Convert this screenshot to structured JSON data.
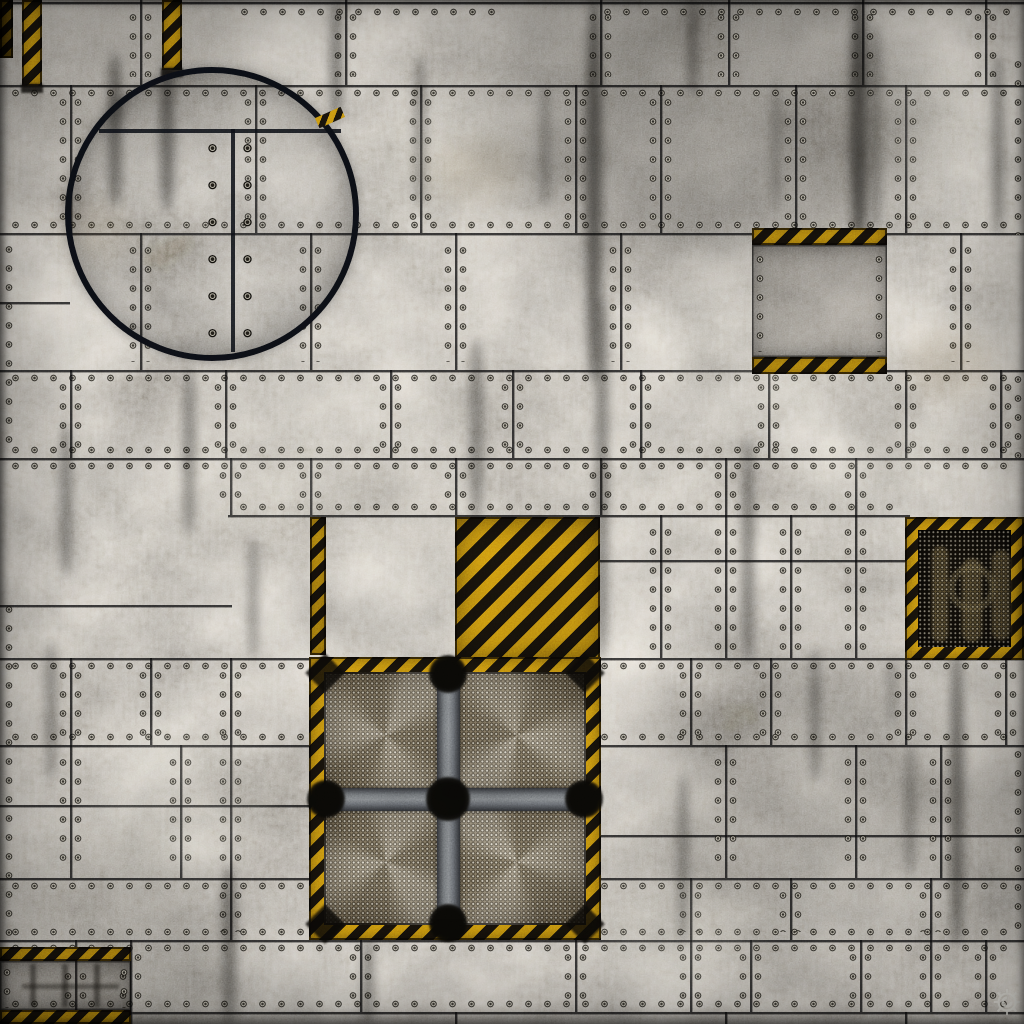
{
  "canvas": {
    "width": 1024,
    "height": 1024
  },
  "palette": {
    "base_gray": "#76736e",
    "seam_dark": "#0c0c0e",
    "rivet_ring": "#15130e",
    "rivet_light": "#c9c4b6",
    "hazard_yellow": "#d9a312",
    "hazard_black": "#19140c",
    "hatch_ring": "#0d1017",
    "mesh_light": "#9a8d74",
    "vent_dark": "#14100a",
    "bar_gray": "#7a7e82",
    "logo_light": "#d9d8d2"
  },
  "stripe_angle": 135,
  "seams": {
    "h": [
      {
        "y": 2,
        "x1": 0,
        "x2": 1024,
        "riv": "none"
      },
      {
        "y": 85,
        "x1": 0,
        "x2": 1024,
        "riv": "below"
      },
      {
        "y": 233,
        "x1": 0,
        "x2": 1024,
        "riv": "above"
      },
      {
        "y": 302,
        "x1": 0,
        "x2": 70,
        "riv": "none"
      },
      {
        "y": 370,
        "x1": 0,
        "x2": 1024,
        "riv": "below"
      },
      {
        "y": 458,
        "x1": 0,
        "x2": 1024,
        "riv": "both"
      },
      {
        "y": 515,
        "x1": 228,
        "x2": 910,
        "riv": "above"
      },
      {
        "y": 560,
        "x1": 598,
        "x2": 1024,
        "riv": "none"
      },
      {
        "y": 605,
        "x1": 0,
        "x2": 232,
        "riv": "none"
      },
      {
        "y": 658,
        "x1": 0,
        "x2": 1024,
        "riv": "below"
      },
      {
        "y": 745,
        "x1": 0,
        "x2": 1024,
        "riv": "above"
      },
      {
        "y": 805,
        "x1": 0,
        "x2": 312,
        "riv": "none"
      },
      {
        "y": 835,
        "x1": 598,
        "x2": 1024,
        "riv": "none"
      },
      {
        "y": 878,
        "x1": 0,
        "x2": 1024,
        "riv": "below"
      },
      {
        "y": 940,
        "x1": 0,
        "x2": 1024,
        "riv": "both"
      },
      {
        "y": 1012,
        "x1": 0,
        "x2": 1024,
        "riv": "above"
      }
    ],
    "v": [
      {
        "x": 140,
        "y1": 0,
        "y2": 85
      },
      {
        "x": 345,
        "y1": 0,
        "y2": 85
      },
      {
        "x": 600,
        "y1": 0,
        "y2": 85
      },
      {
        "x": 728,
        "y1": 0,
        "y2": 85
      },
      {
        "x": 862,
        "y1": 0,
        "y2": 85
      },
      {
        "x": 985,
        "y1": 0,
        "y2": 85
      },
      {
        "x": 70,
        "y1": 85,
        "y2": 233
      },
      {
        "x": 255,
        "y1": 85,
        "y2": 233
      },
      {
        "x": 420,
        "y1": 85,
        "y2": 233
      },
      {
        "x": 575,
        "y1": 85,
        "y2": 233
      },
      {
        "x": 660,
        "y1": 85,
        "y2": 233
      },
      {
        "x": 795,
        "y1": 85,
        "y2": 233
      },
      {
        "x": 905,
        "y1": 85,
        "y2": 233
      },
      {
        "x": 140,
        "y1": 233,
        "y2": 370
      },
      {
        "x": 310,
        "y1": 233,
        "y2": 370
      },
      {
        "x": 455,
        "y1": 233,
        "y2": 370
      },
      {
        "x": 620,
        "y1": 233,
        "y2": 370
      },
      {
        "x": 960,
        "y1": 233,
        "y2": 370
      },
      {
        "x": 70,
        "y1": 370,
        "y2": 458
      },
      {
        "x": 225,
        "y1": 370,
        "y2": 458
      },
      {
        "x": 390,
        "y1": 370,
        "y2": 458
      },
      {
        "x": 512,
        "y1": 370,
        "y2": 458
      },
      {
        "x": 640,
        "y1": 370,
        "y2": 458
      },
      {
        "x": 768,
        "y1": 370,
        "y2": 458
      },
      {
        "x": 905,
        "y1": 370,
        "y2": 458
      },
      {
        "x": 1000,
        "y1": 370,
        "y2": 458
      },
      {
        "x": 230,
        "y1": 458,
        "y2": 515
      },
      {
        "x": 310,
        "y1": 458,
        "y2": 515
      },
      {
        "x": 455,
        "y1": 458,
        "y2": 515
      },
      {
        "x": 600,
        "y1": 458,
        "y2": 515
      },
      {
        "x": 725,
        "y1": 458,
        "y2": 515
      },
      {
        "x": 855,
        "y1": 458,
        "y2": 515
      },
      {
        "x": 660,
        "y1": 515,
        "y2": 658
      },
      {
        "x": 725,
        "y1": 515,
        "y2": 658
      },
      {
        "x": 790,
        "y1": 515,
        "y2": 658
      },
      {
        "x": 855,
        "y1": 515,
        "y2": 658
      },
      {
        "x": 70,
        "y1": 658,
        "y2": 745
      },
      {
        "x": 150,
        "y1": 658,
        "y2": 745
      },
      {
        "x": 230,
        "y1": 658,
        "y2": 745
      },
      {
        "x": 690,
        "y1": 658,
        "y2": 745
      },
      {
        "x": 770,
        "y1": 658,
        "y2": 745
      },
      {
        "x": 905,
        "y1": 658,
        "y2": 745
      },
      {
        "x": 1005,
        "y1": 658,
        "y2": 745
      },
      {
        "x": 70,
        "y1": 745,
        "y2": 878
      },
      {
        "x": 180,
        "y1": 745,
        "y2": 878
      },
      {
        "x": 230,
        "y1": 745,
        "y2": 878
      },
      {
        "x": 725,
        "y1": 745,
        "y2": 878
      },
      {
        "x": 855,
        "y1": 745,
        "y2": 878
      },
      {
        "x": 940,
        "y1": 745,
        "y2": 878
      },
      {
        "x": 230,
        "y1": 878,
        "y2": 940
      },
      {
        "x": 512,
        "y1": 878,
        "y2": 940
      },
      {
        "x": 690,
        "y1": 878,
        "y2": 940
      },
      {
        "x": 790,
        "y1": 878,
        "y2": 940
      },
      {
        "x": 930,
        "y1": 878,
        "y2": 940
      },
      {
        "x": 75,
        "y1": 940,
        "y2": 1012
      },
      {
        "x": 130,
        "y1": 940,
        "y2": 1012
      },
      {
        "x": 360,
        "y1": 940,
        "y2": 1012
      },
      {
        "x": 575,
        "y1": 940,
        "y2": 1012
      },
      {
        "x": 690,
        "y1": 940,
        "y2": 1012
      },
      {
        "x": 750,
        "y1": 940,
        "y2": 1012
      },
      {
        "x": 860,
        "y1": 940,
        "y2": 1012
      },
      {
        "x": 930,
        "y1": 940,
        "y2": 1012
      },
      {
        "x": 985,
        "y1": 940,
        "y2": 1012
      },
      {
        "x": 130,
        "y1": 1012,
        "y2": 1024
      },
      {
        "x": 455,
        "y1": 1012,
        "y2": 1024
      },
      {
        "x": 725,
        "y1": 1012,
        "y2": 1024
      },
      {
        "x": 905,
        "y1": 1012,
        "y2": 1024
      }
    ]
  },
  "rivet_runs": [
    {
      "axis": "h",
      "y": 8,
      "a": 235,
      "b": 505
    },
    {
      "axis": "h",
      "y": 8,
      "a": 598,
      "b": 1018
    },
    {
      "axis": "v",
      "x": 5,
      "a": 240,
      "b": 455
    },
    {
      "axis": "v",
      "x": 5,
      "a": 600,
      "b": 938
    },
    {
      "axis": "v",
      "x": 1014,
      "a": 55,
      "b": 235
    },
    {
      "axis": "v",
      "x": 1014,
      "a": 370,
      "b": 458
    },
    {
      "axis": "v",
      "x": 1014,
      "a": 745,
      "b": 935
    }
  ],
  "shades": [
    {
      "x": 480,
      "y": -40,
      "w": 460,
      "h": 300,
      "c": "#14120f",
      "o": 0.3,
      "b": 40
    },
    {
      "x": -40,
      "y": -40,
      "w": 300,
      "h": 200,
      "c": "#191612",
      "o": 0.22,
      "b": 40
    },
    {
      "x": -30,
      "y": 830,
      "w": 280,
      "h": 240,
      "c": "#161410",
      "o": 0.2,
      "b": 40
    },
    {
      "x": 620,
      "y": 650,
      "w": 430,
      "h": 330,
      "c": "#181612",
      "o": 0.18,
      "b": 46
    },
    {
      "x": 150,
      "y": 360,
      "w": 500,
      "h": 180,
      "c": "#ebe6da",
      "o": 0.1,
      "b": 46
    },
    {
      "x": 600,
      "y": 430,
      "w": 380,
      "h": 120,
      "c": "#e6e2d6",
      "o": 0.08,
      "b": 40
    }
  ],
  "streaks": [
    {
      "x": 108,
      "y": 55,
      "w": 14,
      "h": 150,
      "o": 0.5
    },
    {
      "x": 160,
      "y": 60,
      "w": 14,
      "h": 150,
      "o": 0.5
    },
    {
      "x": 330,
      "y": 0,
      "w": 12,
      "h": 120,
      "o": 0.45
    },
    {
      "x": 415,
      "y": 55,
      "w": 10,
      "h": 150,
      "o": 0.4
    },
    {
      "x": 586,
      "y": 0,
      "w": 16,
      "h": 380,
      "o": 0.55
    },
    {
      "x": 596,
      "y": 300,
      "w": 12,
      "h": 360,
      "o": 0.45
    },
    {
      "x": 688,
      "y": 0,
      "w": 10,
      "h": 95,
      "o": 0.4
    },
    {
      "x": 850,
      "y": 0,
      "w": 18,
      "h": 240,
      "o": 0.6
    },
    {
      "x": 872,
      "y": 25,
      "w": 8,
      "h": 205,
      "o": 0.45
    },
    {
      "x": 993,
      "y": 55,
      "w": 10,
      "h": 180,
      "o": 0.45
    },
    {
      "x": 470,
      "y": 340,
      "w": 13,
      "h": 180,
      "o": 0.4
    },
    {
      "x": 183,
      "y": 368,
      "w": 12,
      "h": 165,
      "o": 0.4
    },
    {
      "x": 60,
      "y": 425,
      "w": 12,
      "h": 150,
      "o": 0.4
    },
    {
      "x": 742,
      "y": 438,
      "w": 12,
      "h": 225,
      "o": 0.45
    },
    {
      "x": 810,
      "y": 650,
      "w": 10,
      "h": 130,
      "o": 0.4
    },
    {
      "x": 950,
      "y": 655,
      "w": 14,
      "h": 290,
      "o": 0.5
    },
    {
      "x": 222,
      "y": 868,
      "w": 14,
      "h": 156,
      "o": 0.45
    },
    {
      "x": 362,
      "y": 938,
      "w": 12,
      "h": 86,
      "o": 0.4
    },
    {
      "x": 678,
      "y": 775,
      "w": 10,
      "h": 168,
      "o": 0.4
    },
    {
      "x": 45,
      "y": 645,
      "w": 12,
      "h": 130,
      "o": 0.35
    },
    {
      "x": 248,
      "y": 540,
      "w": 10,
      "h": 118,
      "o": 0.35
    },
    {
      "x": 888,
      "y": 658,
      "w": 8,
      "h": 70,
      "o": 0.3
    },
    {
      "x": 772,
      "y": 82,
      "w": 8,
      "h": 130,
      "o": 0.3
    },
    {
      "x": 905,
      "y": 745,
      "w": 10,
      "h": 130,
      "o": 0.35
    },
    {
      "x": 540,
      "y": 85,
      "w": 10,
      "h": 120,
      "o": 0.3
    },
    {
      "x": 0,
      "y": 1014,
      "w": 1024,
      "h": 10,
      "o": 0.35
    }
  ],
  "light_patches": [
    {
      "x": 380,
      "y": 100,
      "w": 150,
      "h": 110,
      "o": 0.14
    },
    {
      "x": 670,
      "y": 310,
      "w": 150,
      "h": 110,
      "o": 0.13
    },
    {
      "x": 90,
      "y": 730,
      "w": 180,
      "h": 140,
      "o": 0.13
    },
    {
      "x": 600,
      "y": 880,
      "w": 160,
      "h": 100,
      "o": 0.12
    },
    {
      "x": 810,
      "y": 420,
      "w": 140,
      "h": 80,
      "o": 0.12
    },
    {
      "x": 200,
      "y": 430,
      "w": 160,
      "h": 100,
      "o": 0.1
    },
    {
      "x": 860,
      "y": 60,
      "w": 120,
      "h": 120,
      "o": 0.12
    }
  ],
  "tan_patches": [
    {
      "x": 430,
      "y": 140,
      "w": 90,
      "h": 60,
      "o": 0.12
    },
    {
      "x": 905,
      "y": 330,
      "w": 90,
      "h": 70,
      "o": 0.12
    },
    {
      "x": 480,
      "y": 830,
      "w": 80,
      "h": 60,
      "o": 0.1
    },
    {
      "x": 60,
      "y": 200,
      "w": 70,
      "h": 60,
      "o": 0.1
    }
  ],
  "features": {
    "corner_piece": {
      "x": 0,
      "y": 0,
      "w": 13,
      "h": 58,
      "stripe": 7
    },
    "strip_a": {
      "x": 22,
      "y": 0,
      "w": 20,
      "h": 86,
      "stripe": 8
    },
    "strip_b": {
      "x": 162,
      "y": 0,
      "w": 20,
      "h": 70,
      "stripe": 8
    },
    "hatch": {
      "cx": 212,
      "cy": 214,
      "r": 141,
      "ring": 6,
      "chord_y": 129,
      "chord_x1": 99,
      "chord_x2": 341,
      "seam_x": 231,
      "seam_y1": 129,
      "seam_y2": 352,
      "rivet_cols": [
        212,
        247
      ],
      "rivet_rows": [
        148,
        185,
        222,
        259,
        296,
        333
      ],
      "wedge": {
        "x": 316,
        "y": 112,
        "w": 28,
        "h": 11,
        "rot": -24,
        "stripe": 6
      }
    },
    "hazard_plate_right": {
      "x": 752,
      "y": 228,
      "w": 135,
      "h": 146,
      "band": 17,
      "stripe": 9
    },
    "left_strip": {
      "x": 310,
      "y": 517,
      "w": 16,
      "h": 138,
      "stripe": 8
    },
    "hazard_square": {
      "x": 455,
      "y": 517,
      "w": 145,
      "h": 142,
      "stripe": 11
    },
    "fan": {
      "x": 309,
      "y": 657,
      "w": 292,
      "h": 283,
      "border": 15,
      "bar": 23,
      "cx": 448,
      "cy": 799,
      "blob_r": 19,
      "stripe": 9
    },
    "dark_vent": {
      "x": 905,
      "y": 517,
      "w": 119,
      "h": 143,
      "border": 13,
      "stripe": 8,
      "pipes": [
        {
          "x": 14,
          "y": 16,
          "w": 16,
          "h": 96
        },
        {
          "x": 44,
          "y": 28,
          "w": 20,
          "h": 84
        },
        {
          "x": 74,
          "y": 20,
          "w": 18,
          "h": 90
        }
      ]
    },
    "bottom_left_plate": {
      "x": 0,
      "y": 947,
      "w": 131,
      "h": 77,
      "band": 14,
      "stripe": 8
    },
    "logo": {
      "x": 991,
      "y": 985,
      "w": 32,
      "h": 34
    }
  }
}
